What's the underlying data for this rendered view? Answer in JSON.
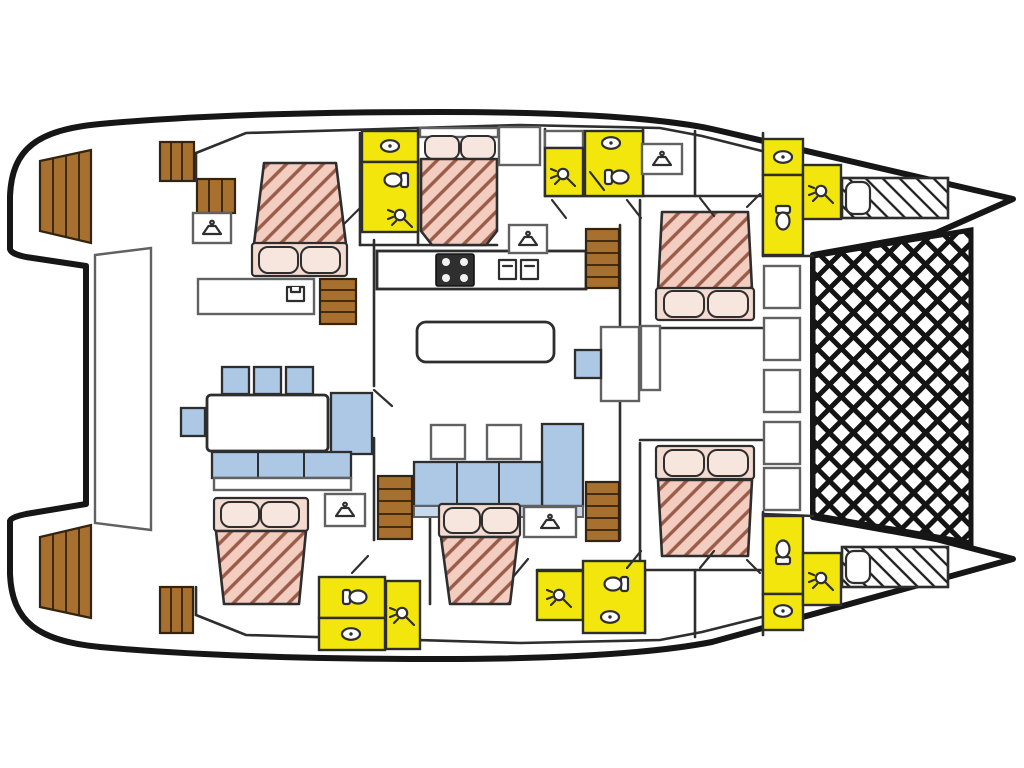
{
  "meta": {
    "description": "Catamaran yacht interior deck plan, top view, bow to the right"
  },
  "colors": {
    "outline": "#161616",
    "wall": "#2e2e2e",
    "furniture_border": "#616161",
    "bathroom_yellow": "#f2e60d",
    "bed_pink": "#f2cdc0",
    "bed_hatch": "#9a5b49",
    "pillow_pink": "#f4dbd1",
    "pillow_light": "#f7e6de",
    "wood_brown": "#a8702e",
    "wood_border": "#33230f",
    "seating_blue": "#acc8e5",
    "seating_blue_light": "#c7daed",
    "stove_dark": "#2f2f2f"
  },
  "inventory": {
    "double_cabins": 6,
    "single_bow_berths": 2,
    "bathroom_compartments": 6,
    "showers": 6,
    "toilets": 6,
    "washbasins": 6,
    "vanity_sinks": 5,
    "interior_staircases": 4,
    "stern_swim_step_flights": 2,
    "cockpit_chairs": 4,
    "galley_burners": 4,
    "trampoline_nets": 1
  }
}
